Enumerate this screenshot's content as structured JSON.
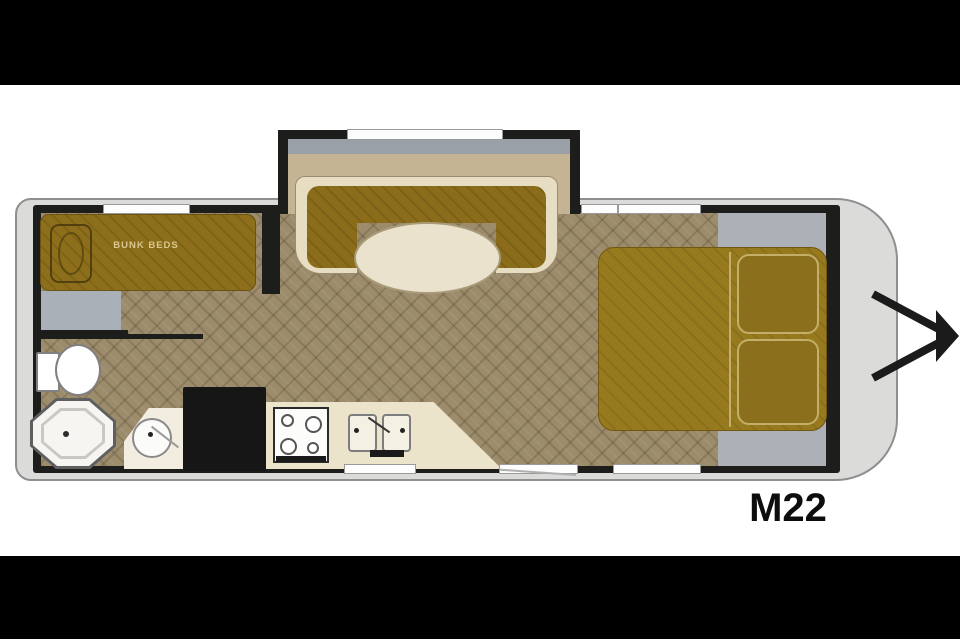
{
  "title": "Travel trailer floor plan",
  "model_label": "M22",
  "labels": {
    "bunk_beds": "BUNK BEDS"
  },
  "furniture": [
    {
      "name": "bunk-beds",
      "label": "BUNK BEDS"
    },
    {
      "name": "wardrobe",
      "label": ""
    },
    {
      "name": "toilet",
      "label": ""
    },
    {
      "name": "shower",
      "label": ""
    },
    {
      "name": "bathroom-vanity-sink",
      "label": ""
    },
    {
      "name": "refrigerator",
      "label": ""
    },
    {
      "name": "range-stove",
      "label": ""
    },
    {
      "name": "double-kitchen-sink",
      "label": ""
    },
    {
      "name": "u-shaped-dinette",
      "label": ""
    },
    {
      "name": "dinette-table",
      "label": ""
    },
    {
      "name": "queen-bed",
      "label": ""
    },
    {
      "name": "pillows",
      "label": ""
    },
    {
      "name": "entry-door",
      "label": ""
    },
    {
      "name": "slide-out",
      "label": ""
    },
    {
      "name": "a-frame-hitch",
      "label": ""
    }
  ],
  "colors": {
    "letterbox": "#000000",
    "background": "#ffffff",
    "shell_gray": "#dbdbd9",
    "wall_black": "#1d1d1b",
    "floor_brown": "#9c8c6c",
    "floor_front_gray": "#adb0b6",
    "upholstery_gold": "#8d6f1b",
    "bed_gold": "#97791e",
    "cream": "#e7ddc2",
    "counter_cream": "#ece3cb",
    "slideout_floor_tan": "#c4b493",
    "label_text_gold": "#d9c78e",
    "model_text": "#0d0d0d"
  }
}
